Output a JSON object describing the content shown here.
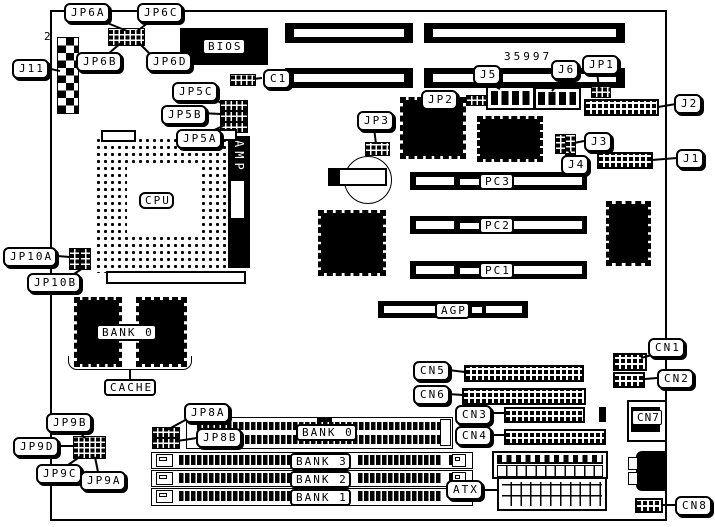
{
  "board": {
    "part_number": "35997",
    "pin_marker": "2"
  },
  "callouts": {
    "jp6a": "JP6A",
    "jp6c": "JP6C",
    "jp6b": "JP6B",
    "jp6d": "JP6D",
    "j11": "J11",
    "jp5c": "JP5C",
    "jp5b": "JP5B",
    "jp5a": "JP5A",
    "c1": "C1",
    "jp3": "JP3",
    "jp2": "JP2",
    "j5": "J5",
    "j6": "J6",
    "jp1": "JP1",
    "j2": "J2",
    "j3": "J3",
    "j4": "J4",
    "j1": "J1",
    "jp10a": "JP10A",
    "jp10b": "JP10B",
    "jp9b": "JP9B",
    "jp9d": "JP9D",
    "jp9c": "JP9C",
    "jp9a": "JP9A",
    "jp8a": "JP8A",
    "jp8b": "JP8B",
    "cn1": "CN1",
    "cn2": "CN2",
    "cn3": "CN3",
    "cn4": "CN4",
    "cn5": "CN5",
    "cn6": "CN6",
    "cn7": "CN7",
    "cn8": "CN8",
    "atx": "ATX"
  },
  "components": {
    "bios": "BIOS",
    "cpu": "CPU",
    "amp": "AMP",
    "cache_bank": "BANK 0",
    "cache": "CACHE",
    "pci3": "PC3",
    "pci2": "PC2",
    "pci1": "PC1",
    "agp": "AGP",
    "dimm_bank0": "BANK 0",
    "simm_bank3": "BANK 3",
    "simm_bank2": "BANK 2",
    "simm_bank1": "BANK 1"
  }
}
